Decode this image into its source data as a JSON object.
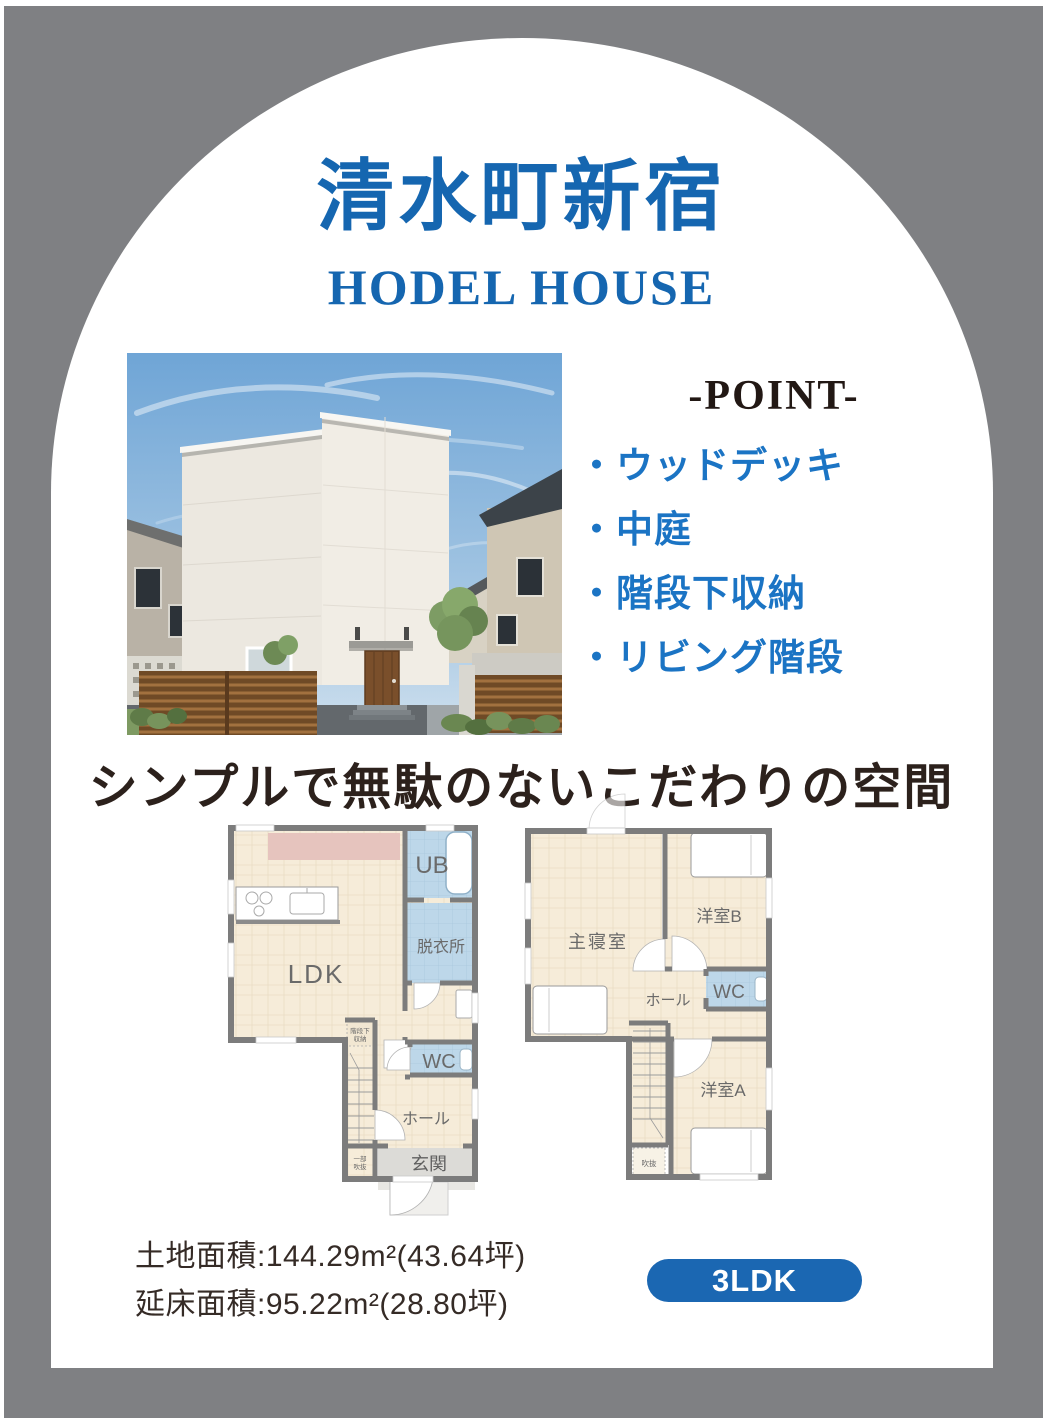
{
  "colors": {
    "background_gray": "#7f8083",
    "panel_white": "#ffffff",
    "accent_blue": "#1566b0",
    "bullet_blue": "#1b74c4",
    "badge_blue": "#1b67b2",
    "text_dark": "#2c211c"
  },
  "header": {
    "title": "清水町新宿",
    "subtitle": "HODEL HOUSE"
  },
  "point": {
    "heading": "-POINT-",
    "items": [
      "・ウッドデッキ",
      "・中庭",
      "・階段下収納",
      "・リビング階段"
    ]
  },
  "tagline": "シンプルで無駄のないこだわりの空間",
  "plans": {
    "f1": {
      "ldk": "LDK",
      "ub": "UB",
      "dressing": "脱衣所",
      "wc": "WC",
      "hall": "ホール",
      "entrance": "玄関",
      "under_stair_1": "階段下",
      "under_stair_2": "収納",
      "partial_void_1": "一部",
      "partial_void_2": "吹抜"
    },
    "f2": {
      "master": "主寝室",
      "room_b": "洋室B",
      "wc": "WC",
      "hall": "ホール",
      "room_a": "洋室A",
      "void": "吹抜"
    }
  },
  "summary": {
    "land_area": "土地面積:144.29m²(43.64坪)",
    "floor_area": "延床面積:95.22m²(28.80坪)",
    "badge": "3LDK"
  }
}
